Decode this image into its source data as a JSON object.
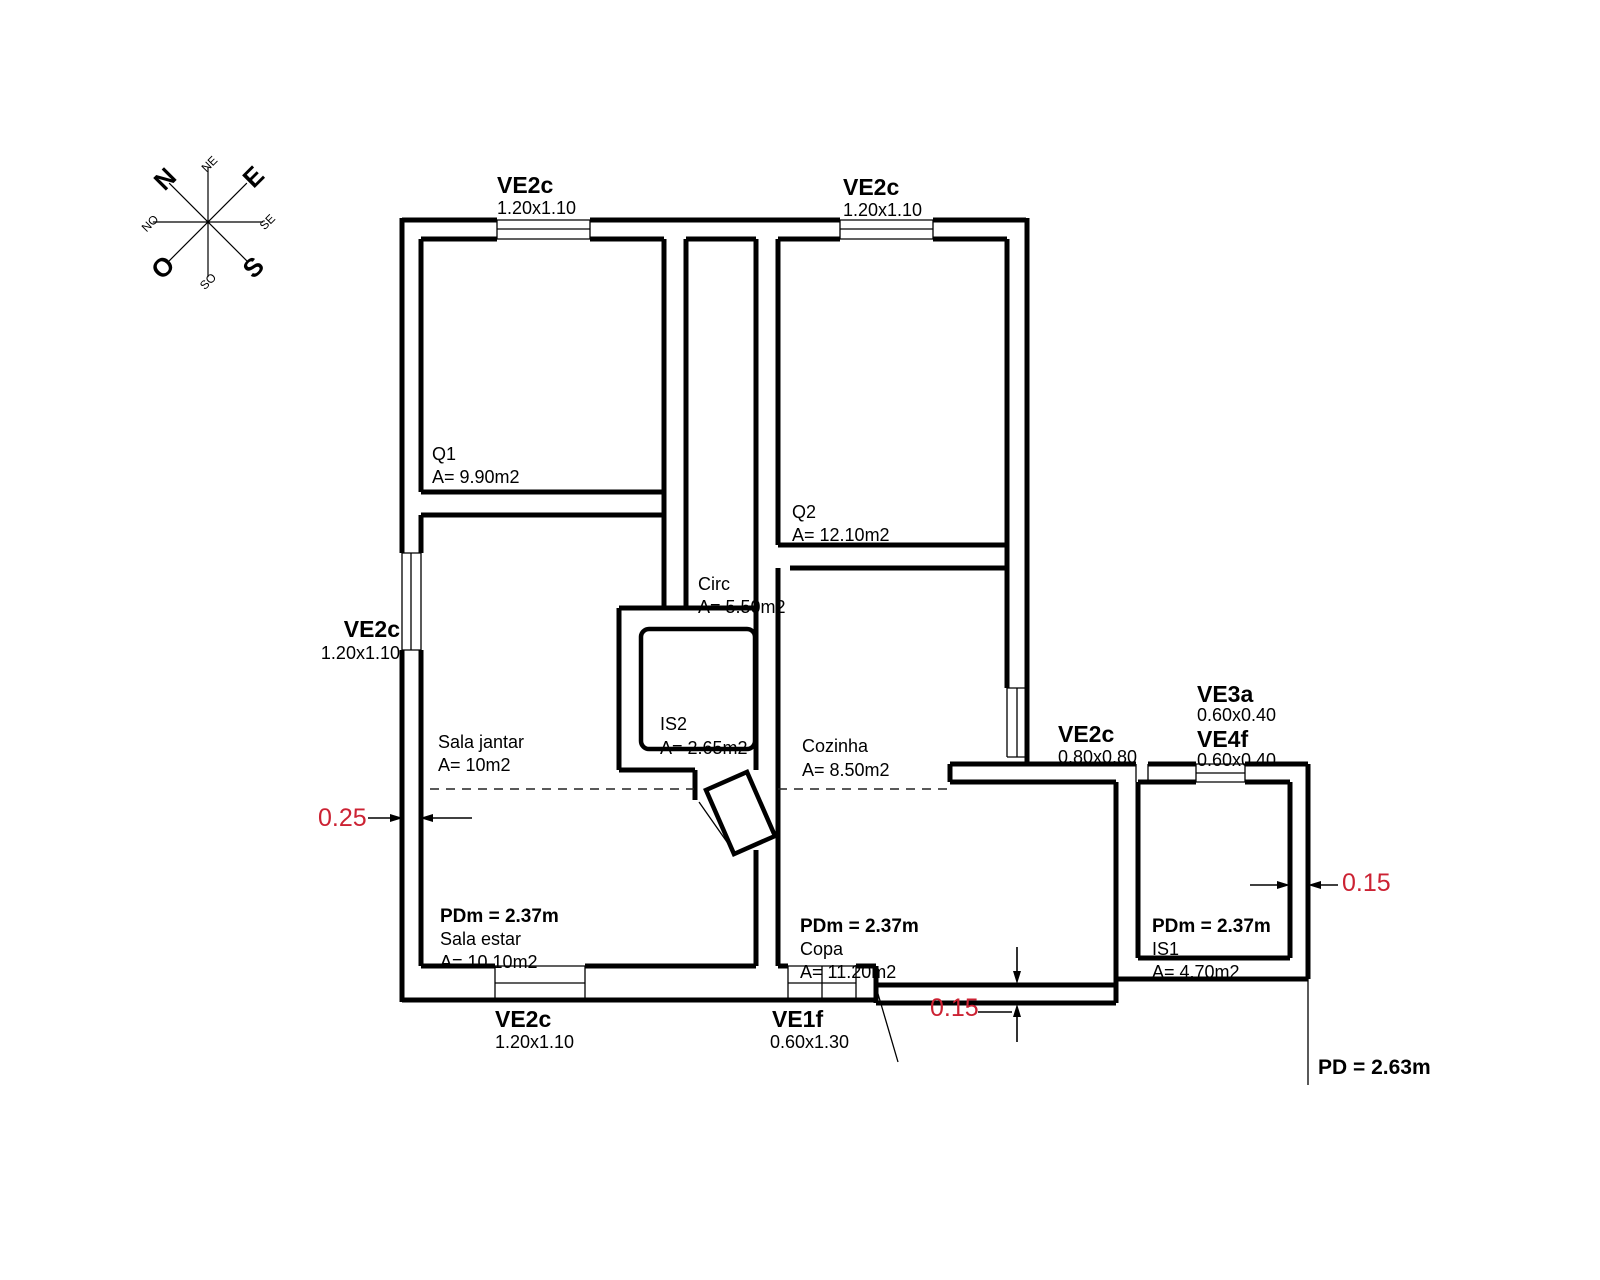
{
  "compass": {
    "n": "N",
    "e": "E",
    "s": "S",
    "o": "O",
    "ne": "NE",
    "se": "SE",
    "so": "SO",
    "no": "NO"
  },
  "windows": [
    {
      "name": "VE2c",
      "size": "1.20x1.10"
    },
    {
      "name": "VE2c",
      "size": "1.20x1.10"
    },
    {
      "name": "VE2c",
      "size": "1.20x1.10"
    },
    {
      "name": "VE2c",
      "size": "1.20x1.10"
    },
    {
      "name": "VE1f",
      "size": "0.60x1.30"
    },
    {
      "name": "VE2c",
      "size": "0.80x0.80"
    },
    {
      "name": "VE3a",
      "size": "0.60x0.40"
    },
    {
      "name": "VE4f",
      "size": "0.60x0.40"
    }
  ],
  "rooms": [
    {
      "name": "Q1",
      "area": "A= 9.90m2"
    },
    {
      "name": "Q2",
      "area": "A= 12.10m2"
    },
    {
      "name": "Circ",
      "area": "A= 5.50m2"
    },
    {
      "name": "IS2",
      "area": "A= 2.65m2"
    },
    {
      "name": "Cozinha",
      "area": "A= 8.50m2"
    },
    {
      "name": "Sala jantar",
      "area": "A= 10m2"
    },
    {
      "name": "Sala estar",
      "area": "A= 10.10m2",
      "pdm": "PDm = 2.37m"
    },
    {
      "name": "Copa",
      "area": "A= 11.20m2",
      "pdm": "PDm = 2.37m"
    },
    {
      "name": "IS1",
      "area": "A= 4.70m2",
      "pdm": "PDm = 2.37m"
    }
  ],
  "dimensions": {
    "wall_left": "0.25",
    "wall_bottom": "0.15",
    "wall_right": "0.15"
  },
  "ceiling": {
    "pd": "PD = 2.63m"
  },
  "colors": {
    "dimension_red": "#cc2233",
    "line_black": "#000000"
  }
}
